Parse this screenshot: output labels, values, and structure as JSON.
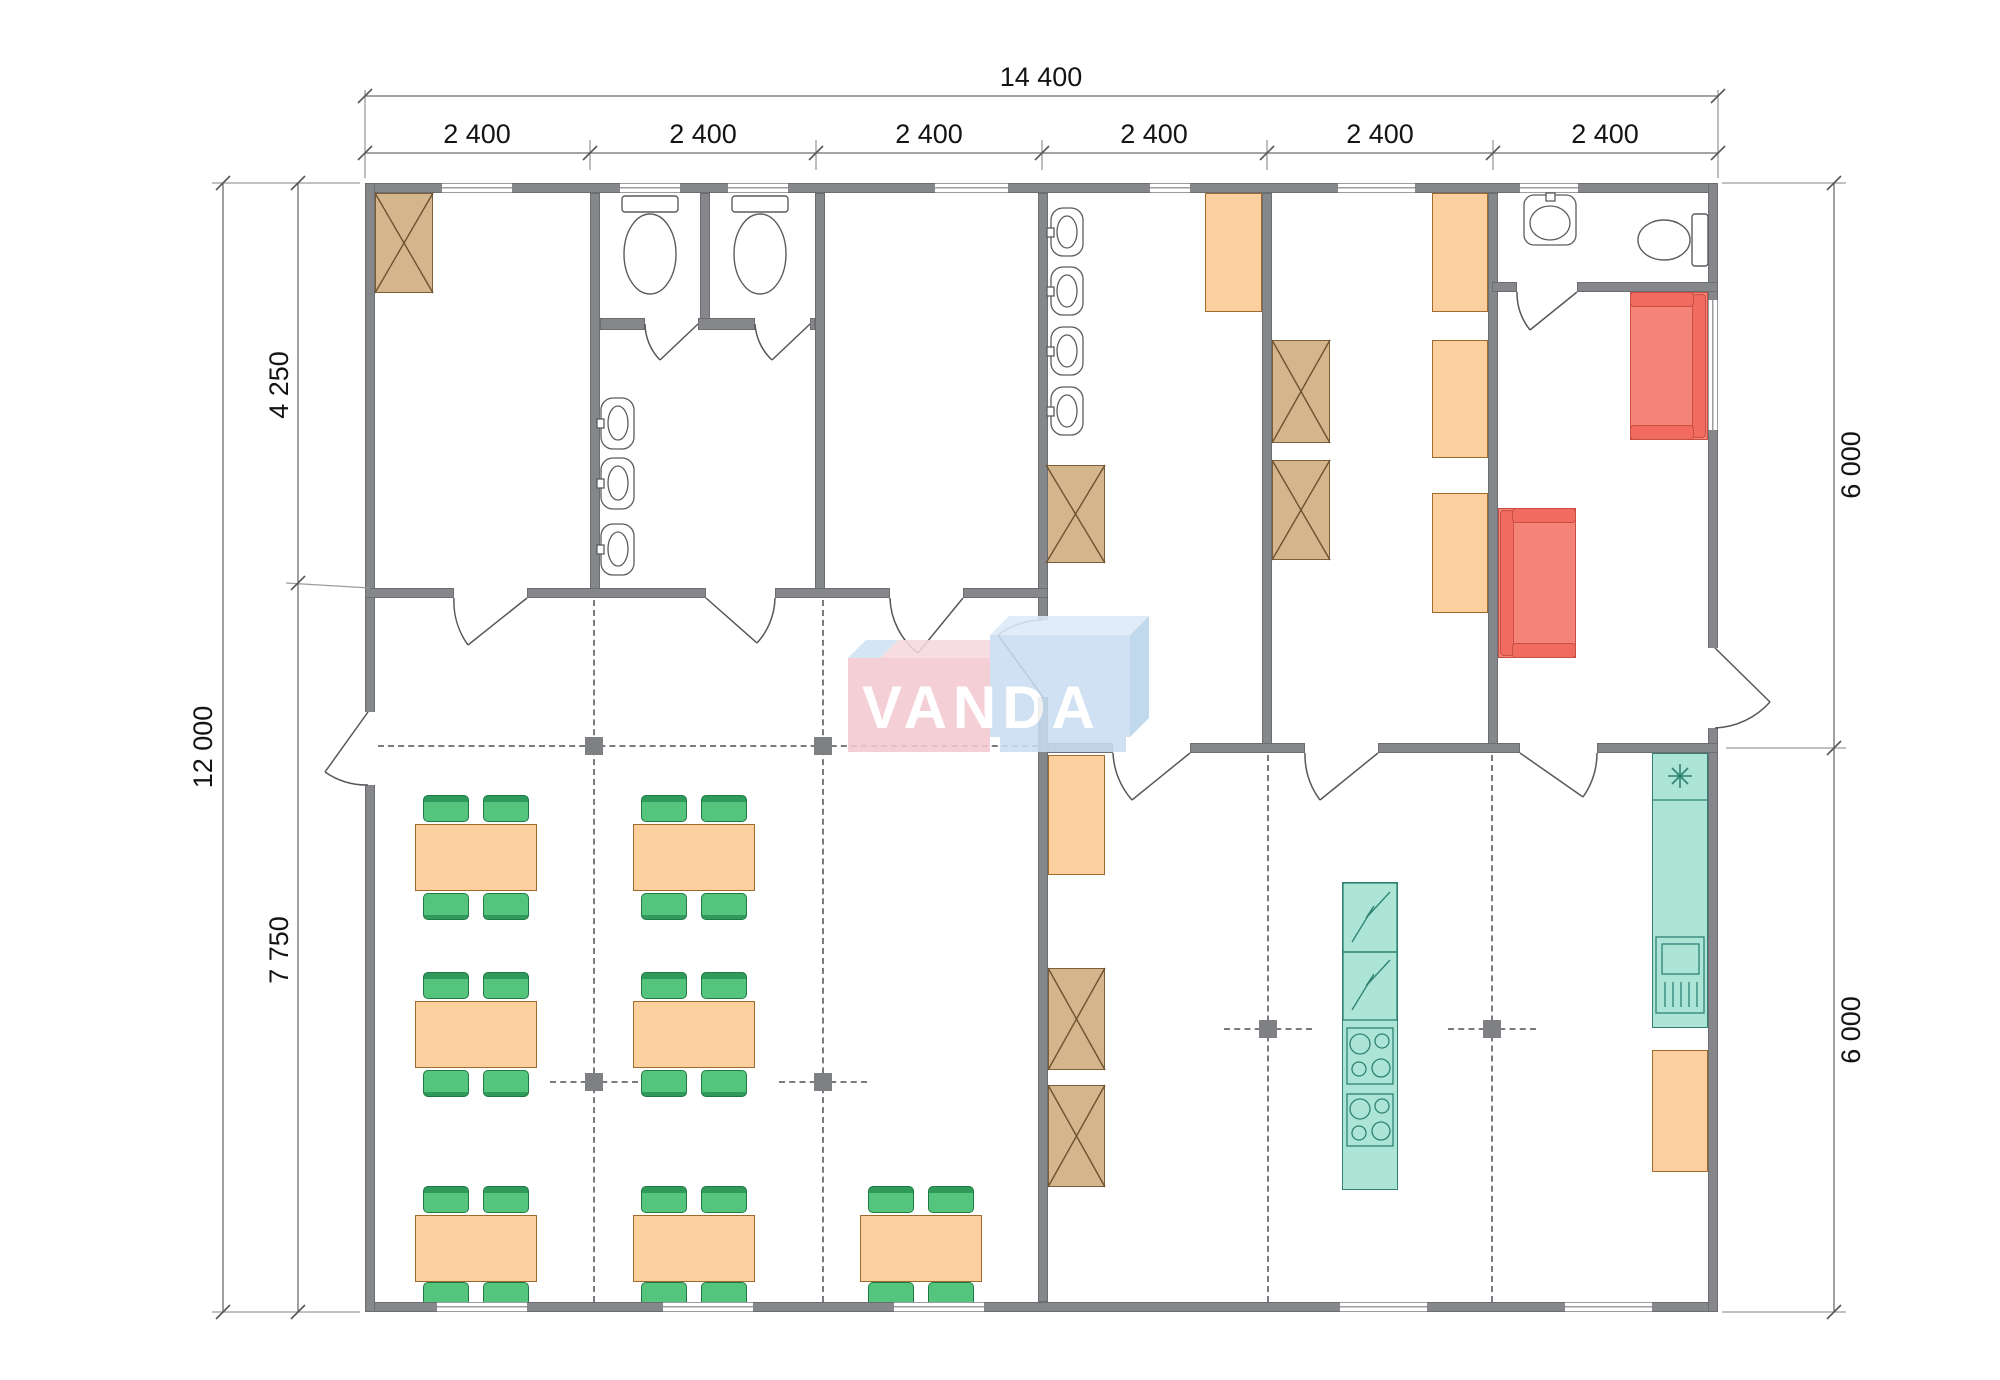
{
  "watermark": {
    "brand": "VANDA"
  },
  "dimensions": {
    "top": {
      "overall": "14 400",
      "segments": [
        "2 400",
        "2 400",
        "2 400",
        "2 400",
        "2 400",
        "2 400"
      ]
    },
    "left": {
      "overall": "12 000",
      "segments": [
        "4 250",
        "7 750"
      ]
    },
    "right": {
      "segments": [
        "6 000",
        "6 000"
      ]
    }
  },
  "icons": {
    "fridge_symbol": "asterisk-8-ray"
  },
  "colors": {
    "wall": "#85878a",
    "table_orange": "#fbcf9e",
    "chair_green": "#55c57d",
    "wardrobe_tan": "#d5b58b",
    "sofa_red": "#f58478",
    "kitchen_teal": "#ace5d6",
    "watermark_pink": "#f4c9d1",
    "watermark_blue": "#c9def1",
    "dimension_text": "#141414"
  }
}
